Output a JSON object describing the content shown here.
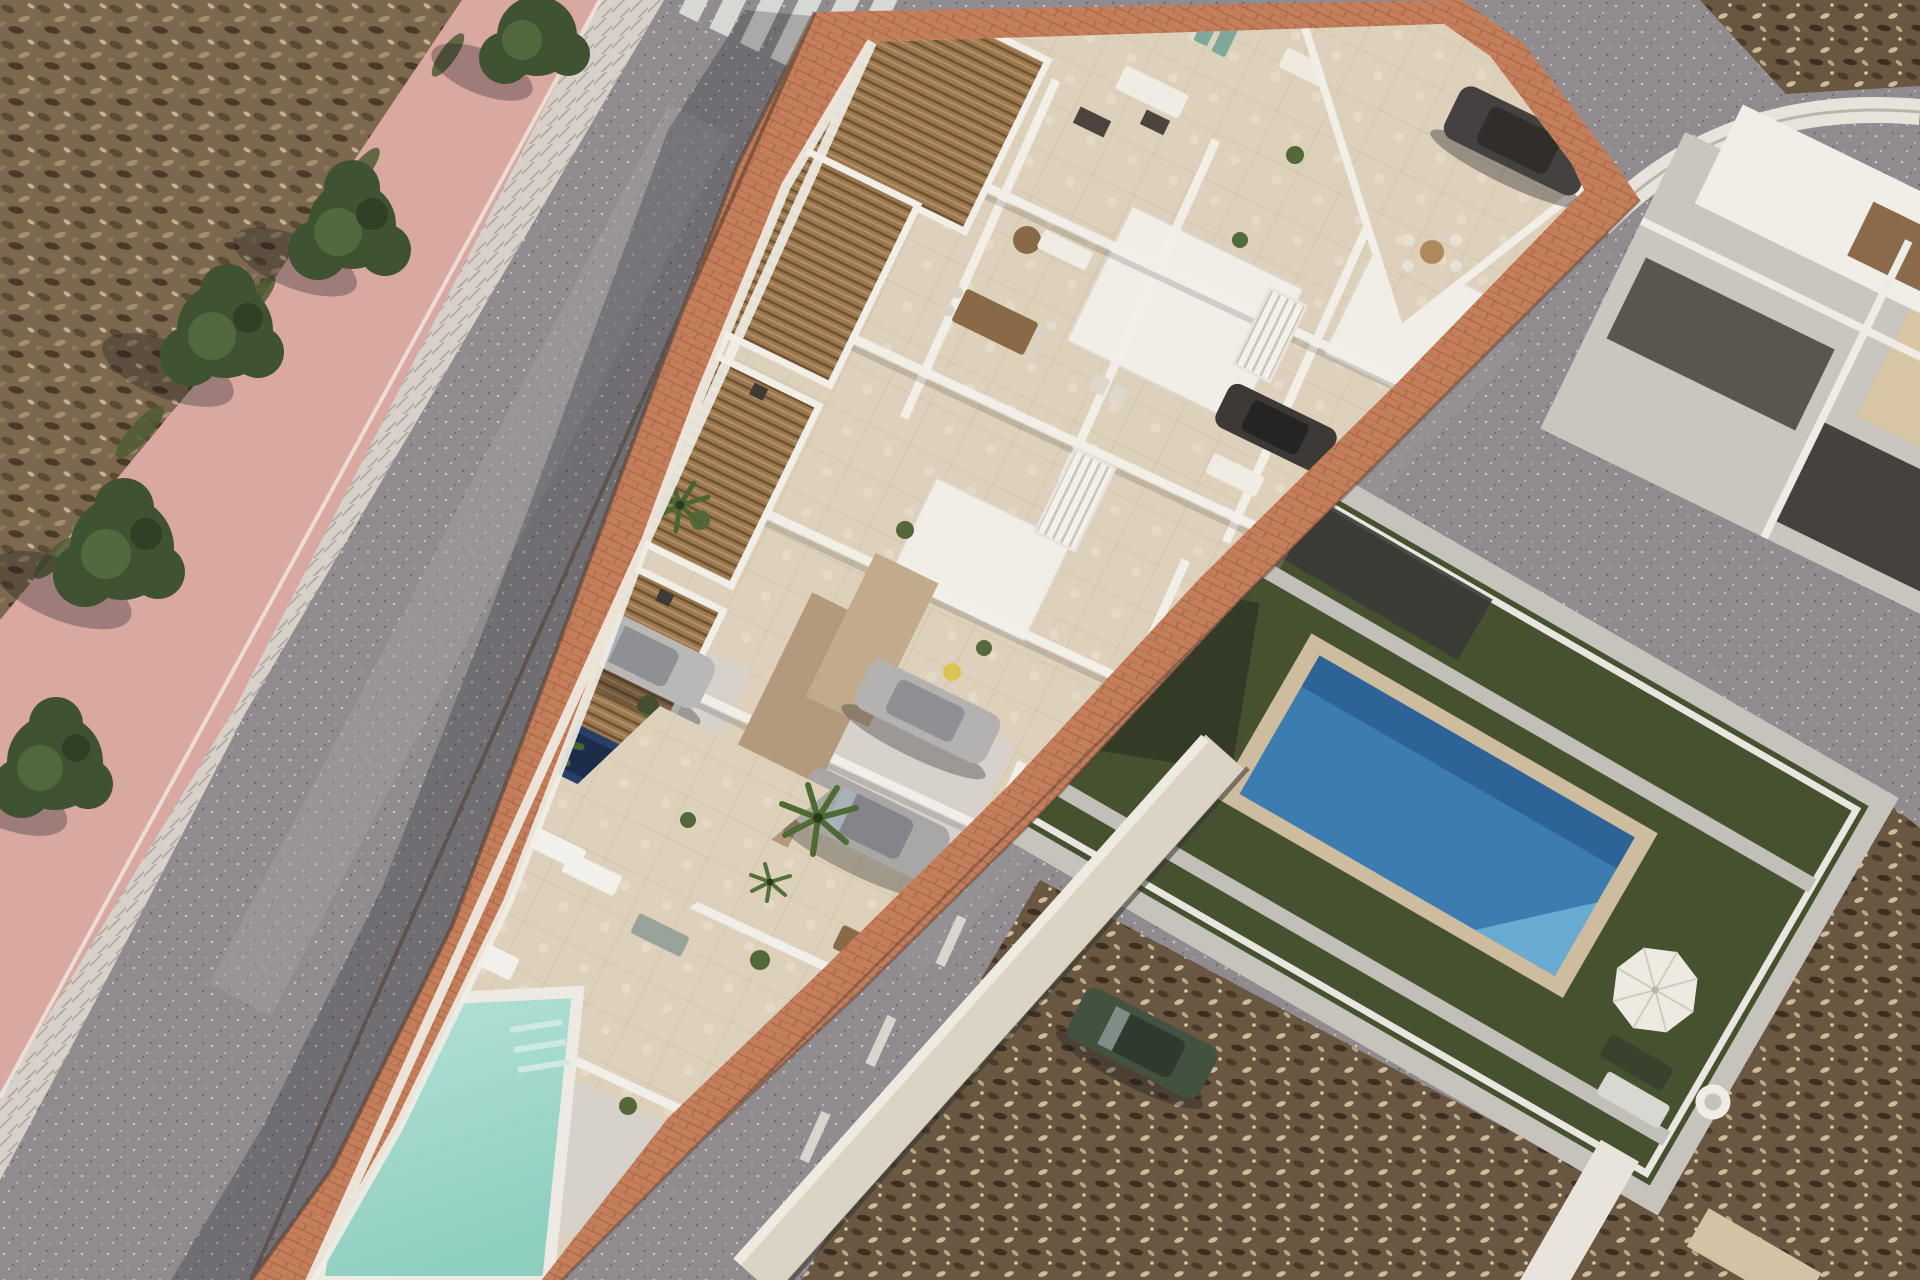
{
  "meta": {
    "title": "Aerial 3D architectural render of a new-build townhouse development",
    "view": "oblique top-down drone view, midday sun, shadows cast to lower-left",
    "location_style": "Mediterranean coastal neighbourhood"
  },
  "colors": {
    "asphalt": "#8f8b8e",
    "asphalt_wear": "#a5a1a3",
    "scrub_base": "#7c684e",
    "lot_base": "#6a5742",
    "sidewalk_pink": "#d9a9a1",
    "curb": "#d7d1c9",
    "terracotta": "#c47e5b",
    "building_white": "#f1eee7",
    "terrace_beige": "#ddd1bb",
    "pergola_wood": "#9a7850",
    "taupe_wall": "#b49a7c",
    "driveway_gray": "#d6d2cb",
    "pool_aqua": "#b7e2d8",
    "pool_aqua_deep": "#8ecfc0",
    "villa_lawn": "#46512f",
    "villa_pool": "#3c7cb0",
    "villa_pool_light": "#6fb0d6",
    "pool_stone": "#cdbd9e",
    "parasol": "#edeae1",
    "tree_green": "#3f5232",
    "palm_green": "#4a6630",
    "crosswalk_white": "#dcdcd8",
    "neighbor_roof_gray": "#c9c5bf",
    "neighbor_roof_dark": "#45423e",
    "neighbor_roof_beige": "#d9c6a4",
    "shadow": "#16161c"
  },
  "scene": {
    "development": {
      "name": "triangular block of white townhouses under construction render",
      "rooftop_pergolas": 6,
      "features": [
        "rooftop terraces with furniture",
        "wooden slat pergolas",
        "staircases",
        "driveways with parked cars",
        "terracotta paved sidewalk ring",
        "communal pool at narrow tip"
      ]
    },
    "community_pool": {
      "shape": "tapering triangle",
      "water": "pale aqua",
      "deck": "beige tiles with white sun loungers",
      "logo": "small dark brand squiggle on pool floor"
    },
    "villa": {
      "name": "existing neighbour villa",
      "lawn": "dark green artificial turf",
      "pool": "deep blue rectangle with sandstone surround",
      "items": [
        "white parasol",
        "sun loungers",
        "swim ring"
      ]
    },
    "roads": {
      "left_street": "gray asphalt with zebra crosswalk at top",
      "right_street": "gray asphalt with parking dashes and parked green car",
      "junction": "top-right corner with curb island"
    },
    "vehicles": [
      {
        "name": "silver-sedan-driveway",
        "color": "#b9b8b6"
      },
      {
        "name": "dark-blue-car-behind-wall",
        "color": "#2a3f66"
      },
      {
        "name": "silver-sedan-right",
        "color": "#b3b2b0"
      },
      {
        "name": "silver-suv",
        "color": "#a8a7a5"
      },
      {
        "name": "dark-car-corner-courtyard",
        "color": "#454140"
      },
      {
        "name": "charcoal-car-upper-driveway",
        "color": "#3c3936"
      },
      {
        "name": "green-car-street",
        "color": "#43523f"
      }
    ],
    "vegetation": {
      "street_trees": 5,
      "palm_trees": 5,
      "grass_tufts": 5,
      "scrub_fields": [
        "top-left",
        "bottom-right",
        "top-right wedge"
      ]
    }
  }
}
